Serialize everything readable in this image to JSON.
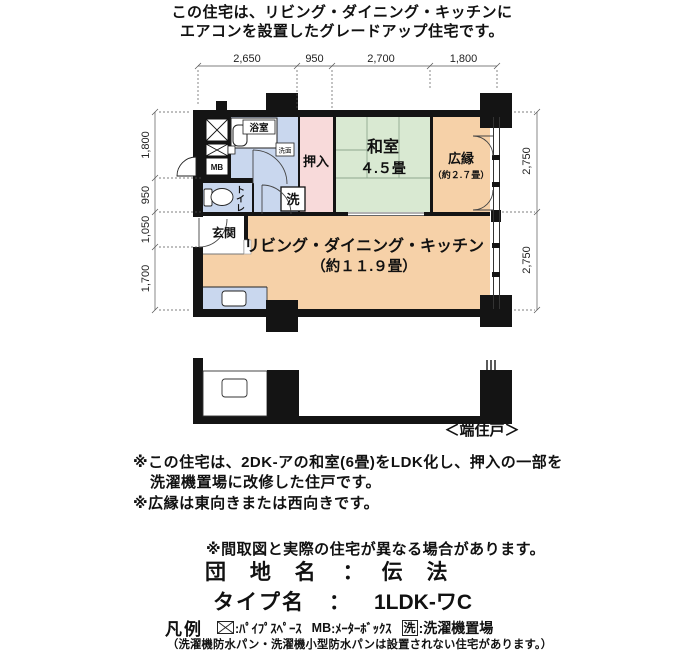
{
  "header": {
    "line1": "この住宅は、リビング・ダイニング・キッチンに",
    "line2": "エアコンを設置したグレードアップ住宅です。"
  },
  "plan": {
    "dims": {
      "top": [
        "2,650",
        "950",
        "2,700",
        "1,800"
      ],
      "left": [
        "1,800",
        "950",
        "1,050",
        "1,700"
      ],
      "right": [
        "2,750",
        "2,750"
      ]
    },
    "labels": {
      "bath": "浴室",
      "washbasin": "洗面",
      "mb": "MB",
      "toilet": "トイレ",
      "laundry": "洗",
      "entrance": "玄関",
      "closet": "押入",
      "japanese_room": "和室",
      "japanese_room_size": "４.５畳",
      "veranda": "広縁",
      "veranda_size": "（約２.７畳）",
      "ldk": "リビング・ダイニング・キッチン",
      "ldk_size": "（約１１.９畳）"
    },
    "unit_position_label": "＜端住戸＞"
  },
  "notes": {
    "note1_line1": "※この住宅は、2DK-アの和室(6畳)をLDK化し、押入の一部を",
    "note1_line2": "洗濯機置場に改修した住戸です。",
    "note2": "※広縁は東向きまたは西向きです。",
    "disclaimer": "※間取図と実際の住宅が異なる場合があります。"
  },
  "estate": {
    "label": "団 地 名",
    "separator": "：",
    "value": "伝 法"
  },
  "unit_type": {
    "label": "タイプ名",
    "separator": "：",
    "value": "1LDK-ワC"
  },
  "legend": {
    "title": "凡例",
    "pipe_space_desc": ":ﾊﾟｲﾌﾟｽﾍﾟｰｽ",
    "mb_label": "MB",
    "mb_desc": ":ﾒｰﾀｰﾎﾞｯｸｽ",
    "laundry_symbol": "洗",
    "laundry_desc": ":洗濯機置場",
    "footnote": "（洗濯機防水パン・洗濯機小型防水パンは設置されない住宅があります。）"
  },
  "colors": {
    "wall": "#141414",
    "water_blue": "#c9d7ee",
    "closet_pink": "#f8dada",
    "tatami_green": "#d9e9d2",
    "ldk_peach": "#f6d1a8"
  }
}
